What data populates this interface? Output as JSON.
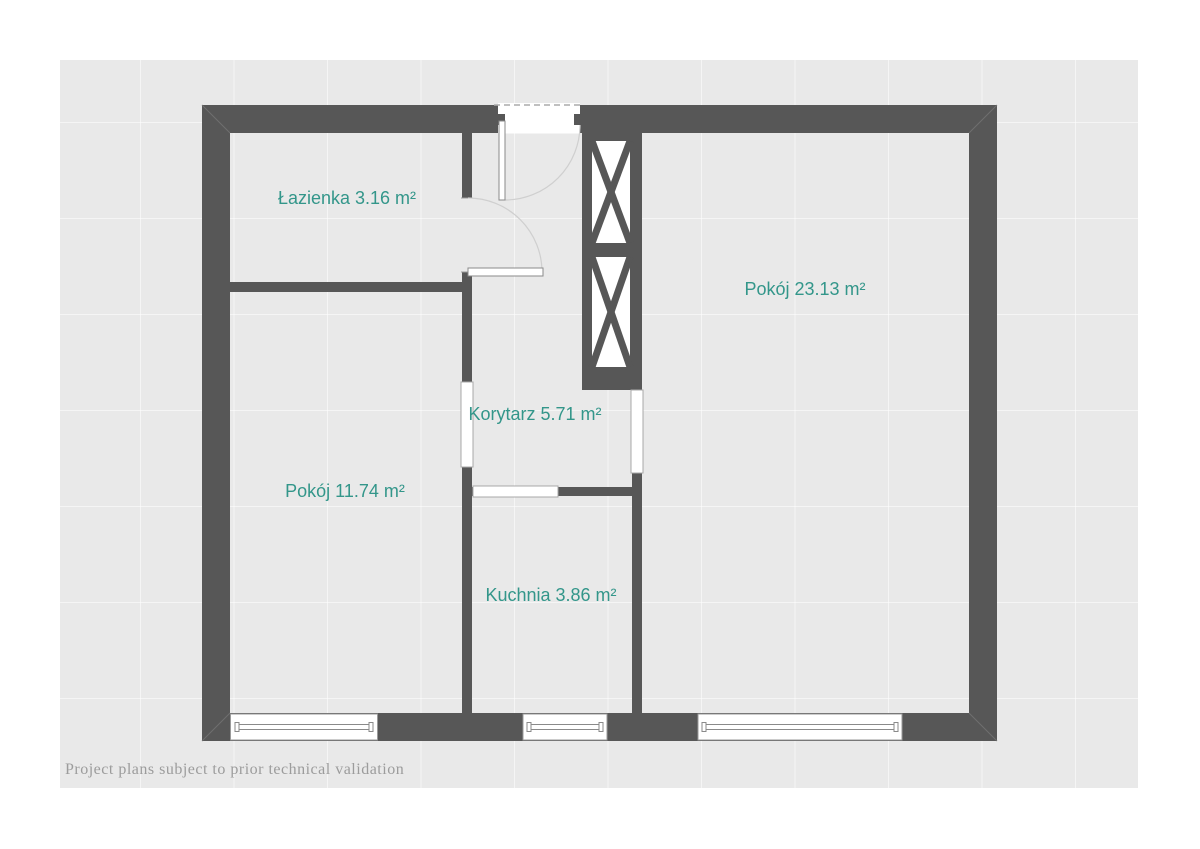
{
  "page": {
    "background": "#ffffff"
  },
  "artboard": {
    "background": "#e9e9e9",
    "grid_line": "rgba(255,255,255,0.55)"
  },
  "plan": {
    "wall_color": "#575757",
    "label_color": "#33968a",
    "rooms": [
      {
        "name": "Łazienka",
        "area_m2": 3.16,
        "label": "Łazienka 3.16 m²"
      },
      {
        "name": "Pokój",
        "area_m2": 23.13,
        "label": "Pokój 23.13 m²"
      },
      {
        "name": "Korytarz",
        "area_m2": 5.71,
        "label": "Korytarz 5.71 m²"
      },
      {
        "name": "Pokój",
        "area_m2": 11.74,
        "label": "Pokój 11.74 m²"
      },
      {
        "name": "Kuchnia",
        "area_m2": 3.86,
        "label": "Kuchnia 3.86 m²"
      }
    ],
    "features": {
      "windows": 3,
      "doors": 2,
      "wall_openings": 3,
      "ventilation_shafts": 2
    }
  },
  "footer": {
    "text": "Project plans subject to prior technical validation"
  }
}
